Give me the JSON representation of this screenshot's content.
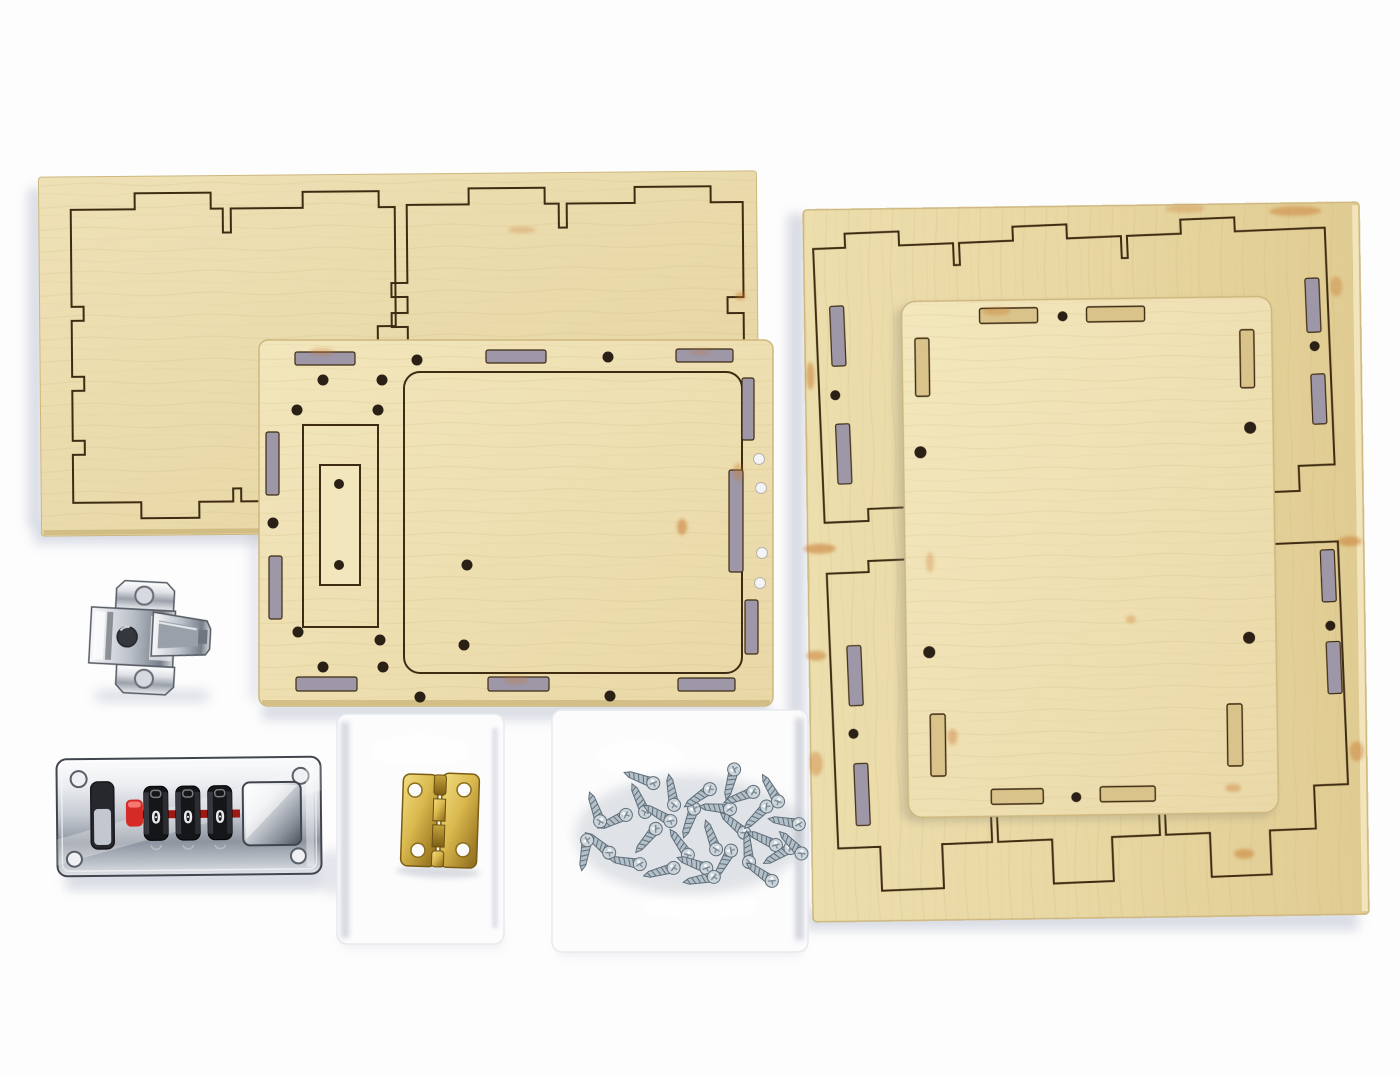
{
  "scene": {
    "type": "product-photo",
    "subject": "DIY wooden box kit: laser-cut plywood panels with combination lock, hinges and screws on a white backdrop"
  },
  "items": [
    {
      "name": "plywood-sheet-left",
      "description": "plywood sheet with two laser-etched castellated panel outlines"
    },
    {
      "name": "panel-middle",
      "description": "laser-cut plywood panel with edge slots, drill holes and etched lid outline"
    },
    {
      "name": "plywood-sheet-right",
      "description": "large plywood sheet with two etched panel outlines and cut mounting slots"
    },
    {
      "name": "panel-overlay",
      "description": "laser-cut plywood lid panel resting on the right sheet"
    },
    {
      "name": "hinge-mounting-plate",
      "description": "chrome cabinet hinge mounting plate with two screw holes"
    },
    {
      "name": "combination-lock",
      "description": "chrome 3-dial combination lock with red reset slider"
    },
    {
      "name": "hinge-bag",
      "description": "white plastic bag holding a brass butt hinge"
    },
    {
      "name": "brass-hinge",
      "description": "small brass butt hinge with four screw holes"
    },
    {
      "name": "screws-bag",
      "description": "clear plastic bag filled with small silver screws"
    }
  ],
  "lock": {
    "dials": [
      "0",
      "0",
      "0"
    ]
  },
  "colors": {
    "background": "#fdfdfd",
    "wood-light": "#f2e6bc",
    "wood-mid": "#e9d8a6",
    "wood-dark": "#d9c38a",
    "wood-edge": "#cdb77e",
    "etch": "#3e2b12",
    "burn": "#c8772e",
    "slot-shadow": "#9d97a8",
    "hole-dark": "#2a2015",
    "hole-white": "#f4f4f6",
    "shadow-blue": "#b6bbcc",
    "steel-outline": "#41464e",
    "chrome-mid": "#b9bfc8",
    "red": "#d42b26",
    "red-dark": "#a01812",
    "brass": "#c9a339",
    "bag": "#fcfcfd",
    "screw-metal": "#b3c0c9",
    "screw-dark": "#5f6e79"
  }
}
